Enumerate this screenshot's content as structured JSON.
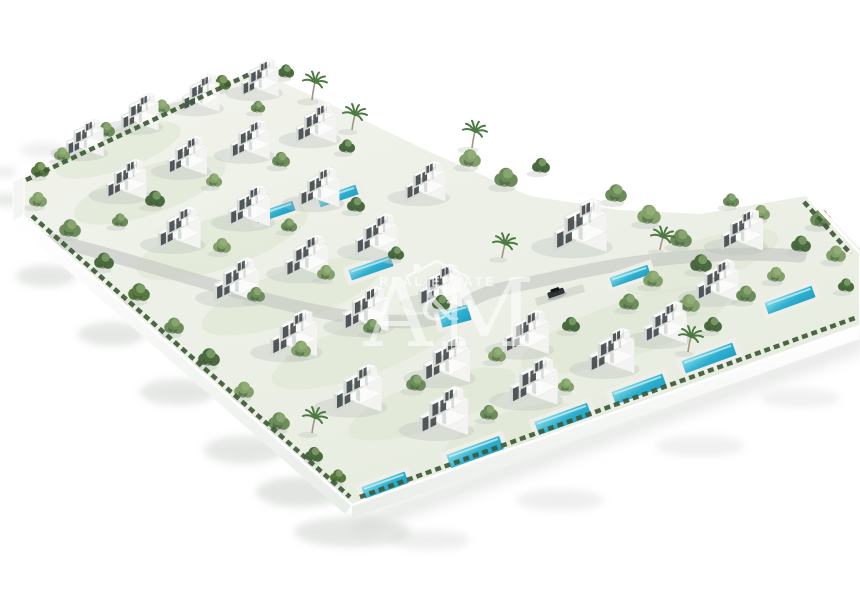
{
  "watermark": {
    "brand_top": "REAL ESTATE",
    "letter_left": "A",
    "ampersand": "&",
    "letter_right": "M",
    "color": "#ffffff",
    "opacity": 0.68,
    "roof_icon": "house-roof-with-chimney"
  },
  "palette": {
    "background": "#ffffff",
    "villa_bright_face": "#f3f4f1",
    "villa_shaded_face": "#d6d9d5",
    "villa_roof": "#fbfbf9",
    "window_glass": "#3c4347",
    "pool_water_light": "#8fdde9",
    "pool_water_deep": "#1f9ec4",
    "pool_deck": "#efeee8",
    "foliage_shades": [
      "#6d8c5b",
      "#57793f",
      "#83a06b",
      "#4a6a3f"
    ],
    "hedge": "#3e5a36",
    "wall_white": "#f6f8f5",
    "road_grey": "#c6cac4",
    "ground_light": "#f1f3ec",
    "ground_dark": "#e7ece0",
    "shadow_grey": "#ccd1cc",
    "car_body": "#2e3336"
  },
  "scene": {
    "plot_polygon": "22,182 140,114 256,70 330,104 430,152 530,196 620,210 700,214 806,196 859,250 859,326 352,505 22,215",
    "road_path": "M 52,240 C 170,268 300,320 408,322 C 455,322 462,296 505,288 C 552,279 598,266 655,260 C 700,255 742,252 800,256",
    "driveway_path": "M 536,302 L 584,288",
    "villas": [
      [
        82,
        149,
        0.72
      ],
      [
        137,
        123,
        0.72
      ],
      [
        198,
        104,
        0.72
      ],
      [
        257,
        89,
        0.72
      ],
      [
        123,
        191,
        0.78
      ],
      [
        184,
        167,
        0.76
      ],
      [
        247,
        151,
        0.76
      ],
      [
        313,
        135,
        0.78
      ],
      [
        176,
        240,
        0.82
      ],
      [
        246,
        218,
        0.8
      ],
      [
        316,
        199,
        0.78
      ],
      [
        422,
        193,
        0.78
      ],
      [
        233,
        293,
        0.86
      ],
      [
        303,
        269,
        0.84
      ],
      [
        373,
        247,
        0.82
      ],
      [
        576,
        241,
        1.02
      ],
      [
        290,
        347,
        0.9
      ],
      [
        362,
        322,
        0.88
      ],
      [
        437,
        298,
        0.84
      ],
      [
        739,
        242,
        0.8
      ],
      [
        354,
        402,
        0.92
      ],
      [
        443,
        373,
        0.9
      ],
      [
        523,
        345,
        0.86
      ],
      [
        714,
        293,
        0.82
      ],
      [
        440,
        425,
        0.94
      ],
      [
        530,
        395,
        0.92
      ],
      [
        608,
        364,
        0.88
      ],
      [
        662,
        335,
        0.82
      ]
    ],
    "pools": [
      [
        475,
        452,
        56,
        14,
        -20
      ],
      [
        563,
        419,
        56,
        14,
        -20
      ],
      [
        639,
        389,
        54,
        13,
        -20
      ],
      [
        709,
        358,
        54,
        13,
        -20
      ],
      [
        790,
        300,
        50,
        12,
        -20
      ],
      [
        385,
        485,
        46,
        12,
        -20
      ],
      [
        275,
        212,
        40,
        10,
        -19
      ],
      [
        338,
        196,
        40,
        10,
        -19
      ],
      [
        371,
        268,
        44,
        11,
        -19
      ],
      [
        455,
        316,
        30,
        16,
        -15
      ],
      [
        630,
        276,
        40,
        10,
        -19
      ]
    ],
    "trees": [
      [
        40,
        176,
        10,
        1
      ],
      [
        62,
        160,
        9,
        2
      ],
      [
        106,
        136,
        10,
        0
      ],
      [
        162,
        112,
        9,
        2
      ],
      [
        222,
        89,
        10,
        1
      ],
      [
        286,
        77,
        9,
        3
      ],
      [
        258,
        112,
        8,
        0
      ],
      [
        38,
        206,
        10,
        2
      ],
      [
        70,
        236,
        12,
        0
      ],
      [
        104,
        268,
        11,
        3
      ],
      [
        139,
        300,
        12,
        1
      ],
      [
        174,
        333,
        11,
        0
      ],
      [
        209,
        365,
        12,
        3
      ],
      [
        244,
        397,
        11,
        2
      ],
      [
        279,
        429,
        12,
        0
      ],
      [
        314,
        461,
        10,
        3
      ],
      [
        338,
        482,
        9,
        1
      ],
      [
        155,
        206,
        11,
        3
      ],
      [
        214,
        186,
        9,
        2
      ],
      [
        281,
        166,
        10,
        0
      ],
      [
        347,
        152,
        9,
        3
      ],
      [
        120,
        226,
        9,
        0
      ],
      [
        222,
        252,
        10,
        2
      ],
      [
        289,
        231,
        9,
        0
      ],
      [
        356,
        211,
        10,
        3
      ],
      [
        256,
        301,
        10,
        0
      ],
      [
        326,
        279,
        10,
        2
      ],
      [
        396,
        259,
        9,
        3
      ],
      [
        301,
        356,
        11,
        2
      ],
      [
        372,
        333,
        10,
        0
      ],
      [
        441,
        309,
        10,
        3
      ],
      [
        416,
        390,
        11,
        0
      ],
      [
        497,
        361,
        10,
        2
      ],
      [
        571,
        331,
        10,
        3
      ],
      [
        489,
        419,
        10,
        0
      ],
      [
        566,
        391,
        9,
        2
      ],
      [
        470,
        166,
        12,
        2
      ],
      [
        506,
        186,
        13,
        0
      ],
      [
        541,
        172,
        10,
        3
      ],
      [
        616,
        201,
        12,
        0
      ],
      [
        649,
        223,
        13,
        2
      ],
      [
        681,
        246,
        12,
        0
      ],
      [
        701,
        271,
        12,
        3
      ],
      [
        653,
        286,
        11,
        2
      ],
      [
        629,
        309,
        11,
        0
      ],
      [
        689,
        311,
        12,
        2
      ],
      [
        713,
        331,
        10,
        3
      ],
      [
        746,
        301,
        11,
        0
      ],
      [
        776,
        281,
        10,
        2
      ],
      [
        801,
        251,
        11,
        3
      ],
      [
        821,
        226,
        12,
        0
      ],
      [
        836,
        261,
        11,
        2
      ],
      [
        846,
        291,
        9,
        3
      ],
      [
        761,
        219,
        10,
        2
      ],
      [
        731,
        206,
        9,
        0
      ]
    ],
    "palms": [
      [
        312,
        100,
        14
      ],
      [
        352,
        130,
        12
      ],
      [
        472,
        148,
        13
      ],
      [
        502,
        258,
        11
      ],
      [
        312,
        433,
        12
      ],
      [
        688,
        352,
        12
      ],
      [
        660,
        250,
        10
      ]
    ],
    "garden_patches": [
      [
        150,
        190,
        80,
        24
      ],
      [
        222,
        242,
        90,
        26
      ],
      [
        292,
        296,
        95,
        26
      ],
      [
        362,
        350,
        95,
        26
      ],
      [
        432,
        404,
        88,
        24
      ],
      [
        510,
        432,
        70,
        20
      ],
      [
        625,
        330,
        110,
        28
      ],
      [
        702,
        262,
        80,
        22
      ],
      [
        118,
        150,
        66,
        20
      ]
    ],
    "outside_shadows": [
      [
        46,
        276,
        30,
        11,
        0.5
      ],
      [
        112,
        334,
        34,
        12,
        0.5
      ],
      [
        178,
        392,
        38,
        13,
        0.5
      ],
      [
        244,
        450,
        40,
        14,
        0.5
      ],
      [
        300,
        492,
        44,
        15,
        0.55
      ],
      [
        352,
        532,
        58,
        15,
        0.5
      ],
      [
        10,
        200,
        18,
        7,
        0.45
      ],
      [
        4,
        172,
        13,
        5,
        0.4
      ],
      [
        430,
        540,
        40,
        10,
        0.32
      ],
      [
        560,
        500,
        44,
        11,
        0.32
      ],
      [
        700,
        446,
        44,
        11,
        0.3
      ],
      [
        800,
        398,
        40,
        10,
        0.28
      ],
      [
        44,
        150,
        24,
        8,
        0.3
      ],
      [
        70,
        180,
        26,
        9,
        0.3
      ]
    ],
    "walls": {
      "bottom_left": {
        "x1": 22,
        "y1": 215,
        "x2": 352,
        "y2": 505,
        "dx": -7,
        "dy": 9
      },
      "front": {
        "x1": 352,
        "y1": 505,
        "x2": 859,
        "y2": 326,
        "dx": 0,
        "dy": 13
      },
      "right": {
        "x1": 808,
        "y1": 198,
        "x2": 859,
        "y2": 252,
        "dx": 6,
        "dy": 2
      },
      "left_cap": "13,181 24,176 24,216 13,221"
    },
    "hedges": [
      [
        32,
        216,
        350,
        497
      ],
      [
        360,
        497,
        855,
        318
      ],
      [
        804,
        202,
        851,
        254
      ],
      [
        26,
        180,
        250,
        74
      ]
    ],
    "car": {
      "x": 556,
      "y": 293,
      "angle": -19
    }
  }
}
